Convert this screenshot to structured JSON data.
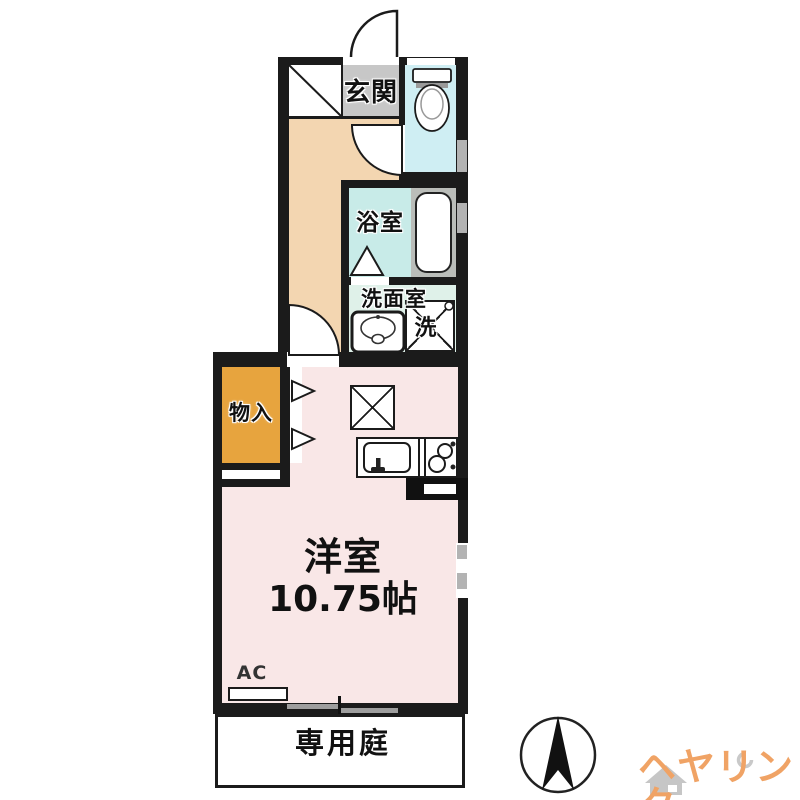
{
  "rooms": {
    "entrance": {
      "label": "玄関"
    },
    "bath": {
      "label": "浴室"
    },
    "washroom": {
      "label": "洗面室"
    },
    "laundry": {
      "label": "洗"
    },
    "storage": {
      "label": "物入"
    },
    "western_room": {
      "label": "洋室",
      "size": "10.75帖"
    },
    "garden": {
      "label": "専用庭"
    }
  },
  "labels": {
    "ac": "AC"
  },
  "branding": {
    "logo": "ヘヤリンク"
  },
  "icons": {
    "compass": "north-arrow-icon",
    "logo_house": "house-icon"
  },
  "colors": {
    "wall": "#1b1b1b",
    "entrance_tile": "#c7c7c7",
    "hallway": "#f3d6b1",
    "toilet_room": "#cfeef3",
    "bath_room": "#c8ebe8",
    "washroom": "#dff1e9",
    "storage": "#e7a43e",
    "main_room": "#f9e7e7",
    "tub_frame": "#babdb9",
    "window": "#b3b3b3",
    "logo": "#f0a365"
  }
}
